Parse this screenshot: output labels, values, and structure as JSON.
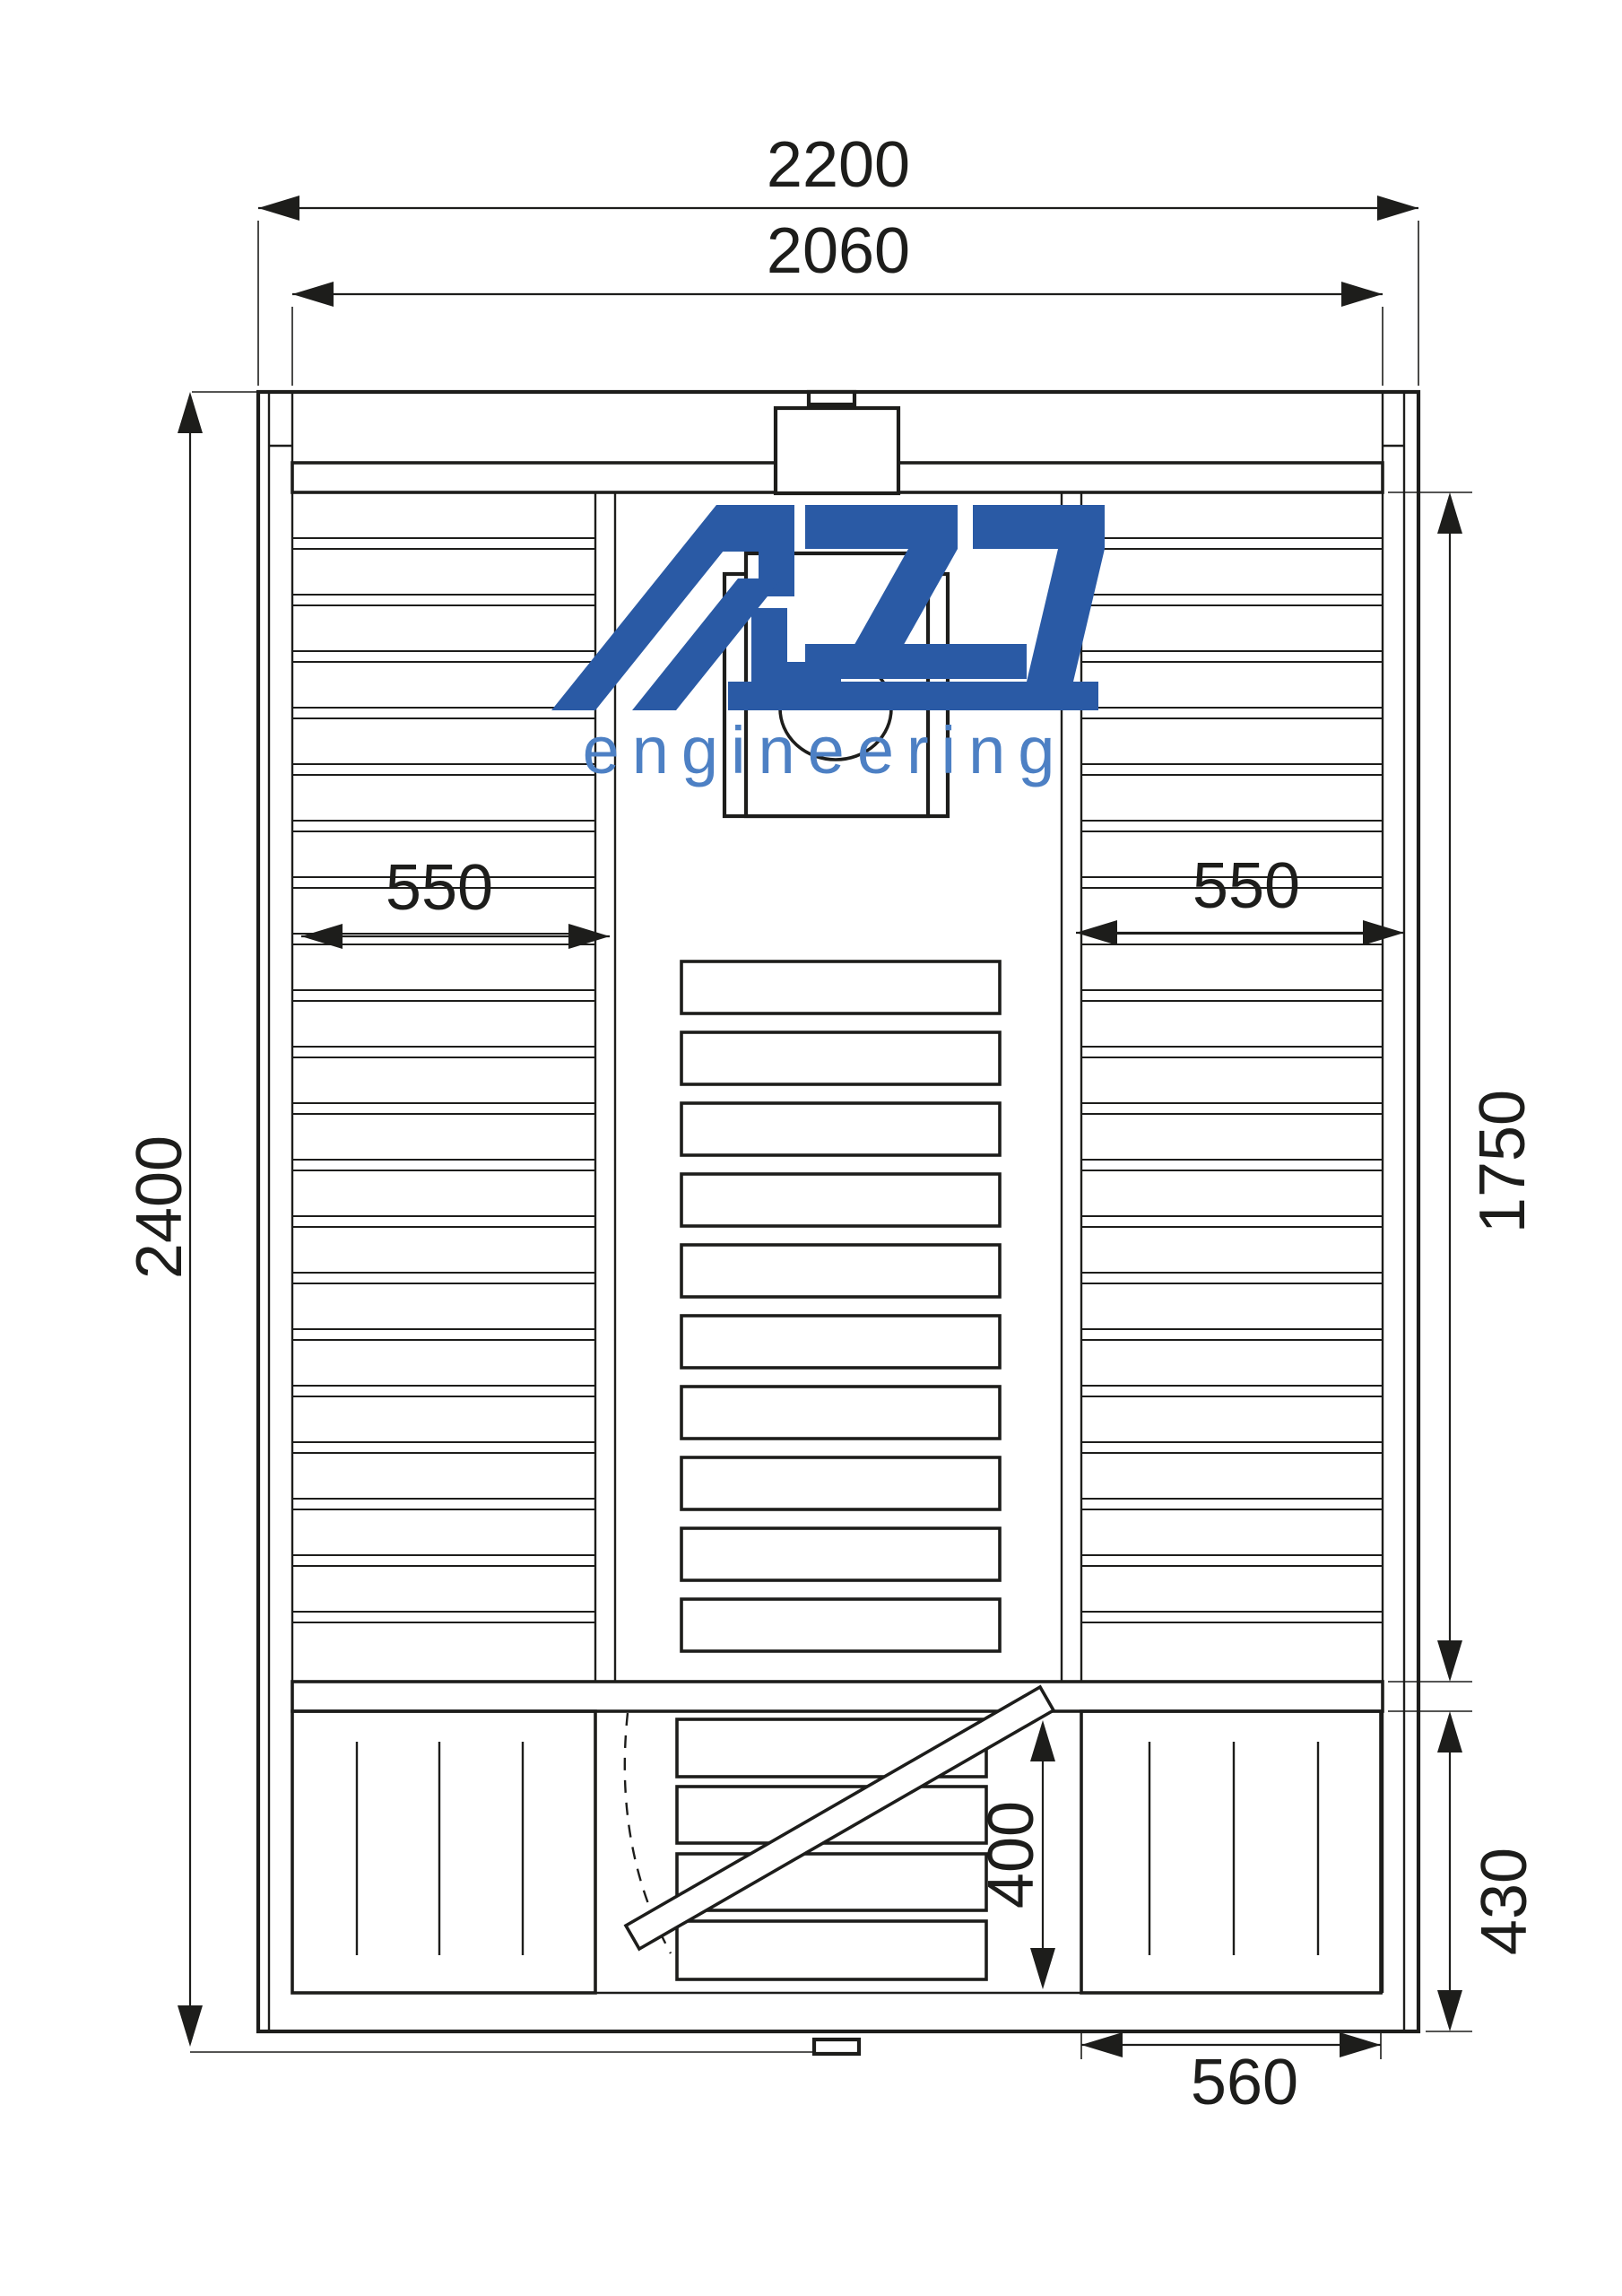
{
  "logo": {
    "brand": "AZS",
    "subtitle": "engineering",
    "brand_color": "#2a5aa5",
    "subtitle_color": "#4d80c4"
  },
  "dimensions": {
    "overall_width_mm": "2200",
    "inner_width_mm": "2060",
    "overall_depth_mm": "2400",
    "main_room_depth_mm": "1750",
    "left_bench_width_mm": "550",
    "right_bench_width_mm": "550",
    "door_opening_mm": "400",
    "vestibule_depth_mm": "430",
    "vestibule_bench_width_mm": "560"
  },
  "style": {
    "line_color": "#1d1d1b",
    "background": "#ffffff"
  }
}
